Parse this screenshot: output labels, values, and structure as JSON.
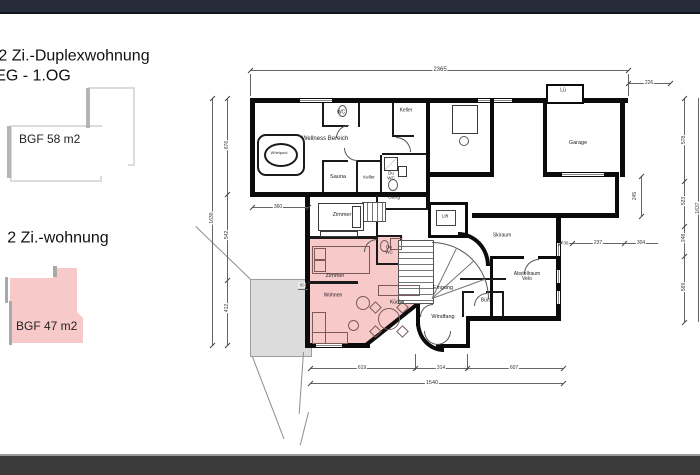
{
  "window": {
    "top_bar_color": "#262c3a",
    "bottom_bar_color": "#3b3b3b"
  },
  "legend": {
    "duplex": {
      "title": "2 Zi.-Duplexwohnung",
      "subtitle": "EG - 1.OG",
      "area": "BGF  58 m2",
      "fill": "#ffffff"
    },
    "flat": {
      "title": "2 Zi.-wohnung",
      "area": "BGF  47 m2",
      "fill": "#f7c9c9"
    }
  },
  "plan": {
    "highlight_color": "#f7c9c9",
    "rooms": {
      "wellness": "Wellness Bereich",
      "whirlpool": "Whirlpool",
      "wc": "WC",
      "keller_top": "Keller",
      "sauna": "Sauna",
      "keller_small": "Keller",
      "du_wc_upper": "Du WC",
      "gang": "Gang",
      "zimmer_upper": "Zimmer",
      "lueftung": "Lü",
      "garage": "Garage",
      "lift": "Lift",
      "skiraum": "Skiraum",
      "abstellraum": "Abstellraum Velo",
      "buero": "Büro",
      "eingang": "Eingang",
      "windfang": "Windfang",
      "zimmer_pink": "Zimmer",
      "du_wc_pink": "Du WC",
      "wohnen": "Wohnen",
      "kueche": "Küche"
    },
    "dimensions": {
      "top_total": "2365",
      "top_right": "226",
      "left_total": "1630",
      "left_1": "676",
      "left_2": "542",
      "left_3": "412",
      "right_1": "578",
      "right_2": "523",
      "right_3": "248",
      "right_4": "569",
      "right_total": "1637",
      "step_v": "245",
      "step_1": "36",
      "step_2": "237",
      "step_3": "304",
      "inner_width": "360",
      "inner_small": "80",
      "bottom_1": "619",
      "bottom_2": "314",
      "bottom_3": "607",
      "bottom_total": "1540"
    }
  }
}
